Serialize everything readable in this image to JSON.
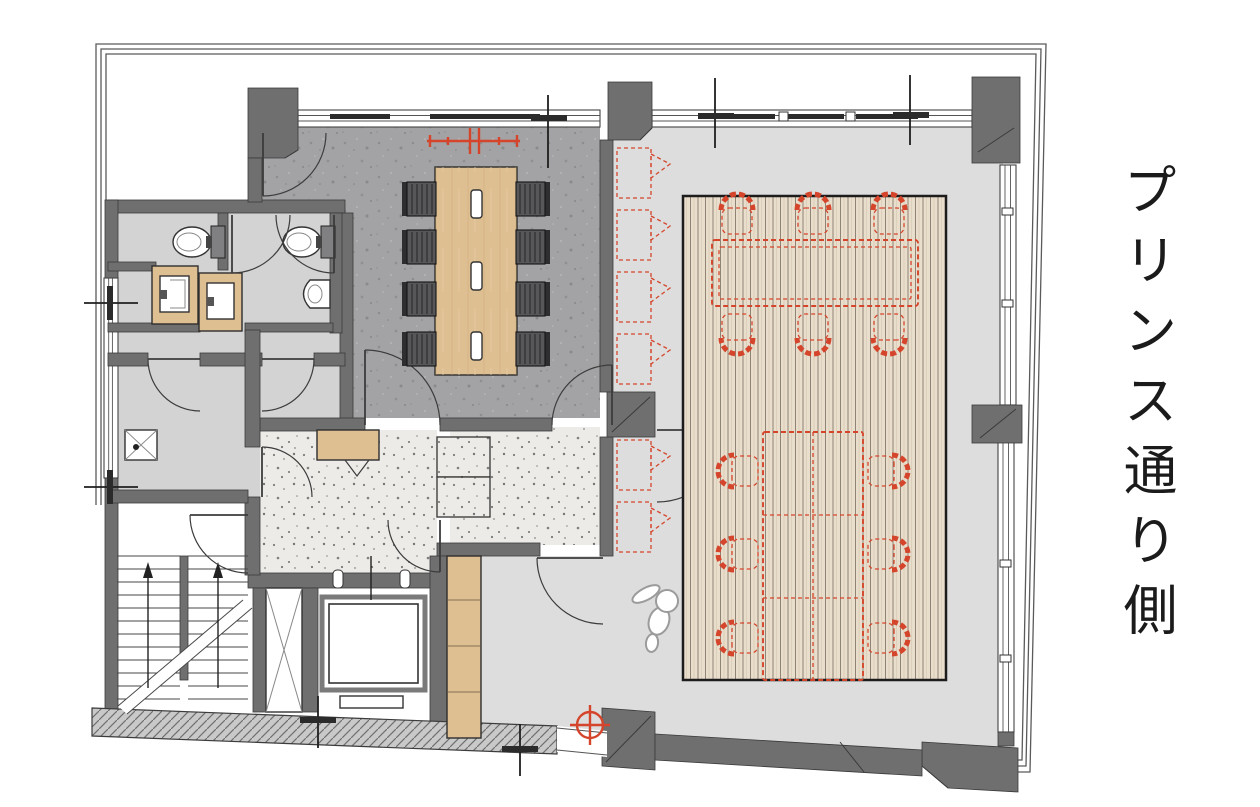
{
  "annotation": {
    "side_label": "プリンス通り側"
  },
  "palette": {
    "wall": "#6f6f70",
    "wall_line": "#3a3a3a",
    "accent_red": "#d5452c",
    "wood": "#ddbf92",
    "deck_bg": "#e9ddcb",
    "deck_line": "#8f8375",
    "concrete_floor": "#a3a3a5",
    "terrazzo_floor": "#ecebe8",
    "event_floor": "#dcdddc",
    "service_floor": "#d3d3d3",
    "frame_line": "#5a5a5a",
    "chair_black": "#57575a",
    "label": "#1b1b1b"
  }
}
